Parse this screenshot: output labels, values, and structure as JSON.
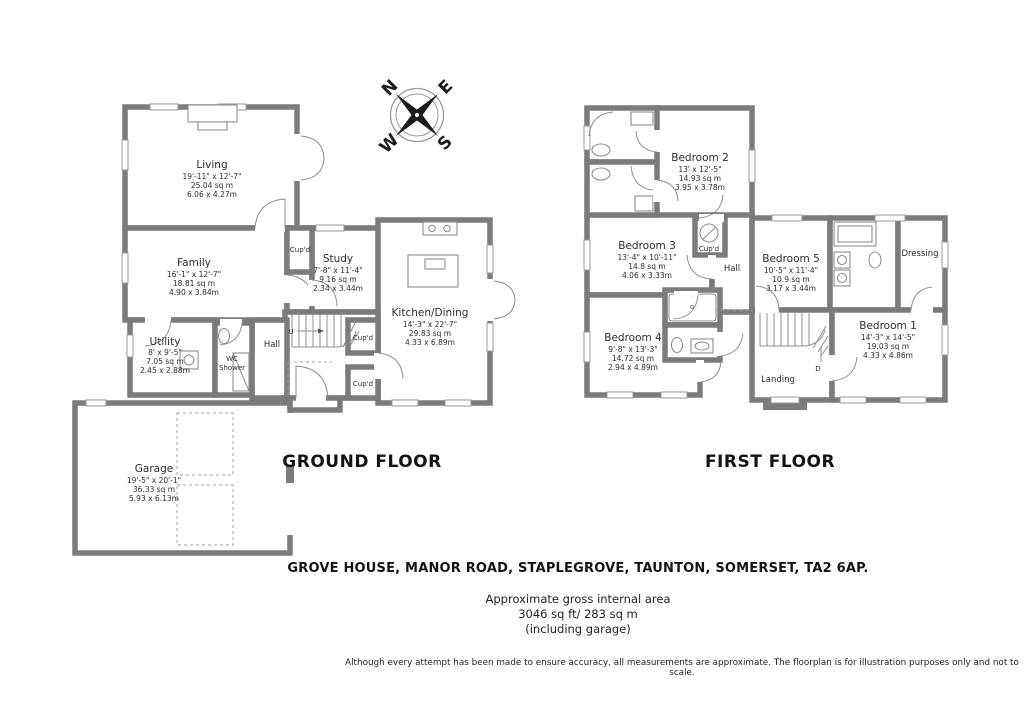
{
  "page": {
    "background": "#ffffff",
    "wall_color": "#7b7b7b"
  },
  "floors": {
    "ground": {
      "title": "GROUND FLOOR",
      "rooms": {
        "living": {
          "name": "Living",
          "dims_ft": "19'-11\" x 12'-7\"",
          "area": "25.04 sq m",
          "dims_m": "6.06 x 4.27m"
        },
        "family": {
          "name": "Family",
          "dims_ft": "16'-1\" x 12'-7\"",
          "area": "18.81 sq m",
          "dims_m": "4.90 x 3.84m"
        },
        "study": {
          "name": "Study",
          "dims_ft": "7'-8\" x 11'-4\"",
          "area": "9.16 sq m",
          "dims_m": "2.34 x 3.44m"
        },
        "kitchen": {
          "name": "Kitchen/Dining",
          "dims_ft": "14'-3\" x 22'-7\"",
          "area": "29.83 sq m",
          "dims_m": "4.33 x 6.89m"
        },
        "utility": {
          "name": "Utility",
          "dims_ft": "8' x 9'-5\"",
          "area": "7.05 sq m",
          "dims_m": "2.45 x 2.88m"
        },
        "garage": {
          "name": "Garage",
          "dims_ft": "19'-5\" x 20'-1\"",
          "area": "36.33 sq m",
          "dims_m": "5.93 x 6.13m"
        }
      }
    },
    "first": {
      "title": "FIRST FLOOR",
      "rooms": {
        "bed1": {
          "name": "Bedroom 1",
          "dims_ft": "14'-3\" x 14'-5\"",
          "area": "19.03 sq m",
          "dims_m": "4.33 x 4.86m"
        },
        "bed2": {
          "name": "Bedroom 2",
          "dims_ft": "13' x 12'-5\"",
          "area": "14.93 sq m",
          "dims_m": "3.95 x 3.78m"
        },
        "bed3": {
          "name": "Bedroom 3",
          "dims_ft": "13'-4\" x 10'-11\"",
          "area": "14.8 sq m",
          "dims_m": "4.06 x 3.33m"
        },
        "bed4": {
          "name": "Bedroom 4",
          "dims_ft": "9'-8\" x 13'-3\"",
          "area": "14.72 sq m",
          "dims_m": "2.94 x 4.89m"
        },
        "bed5": {
          "name": "Bedroom 5",
          "dims_ft": "10'-5\" x 11'-4\"",
          "area": "10.9 sq m",
          "dims_m": "3.17 x 3.44m"
        }
      }
    }
  },
  "labels": {
    "hall": "Hall",
    "landing": "Landing",
    "dressing": "Dressing",
    "cupd": "Cup'd",
    "wc": "WC",
    "shower": "Shower",
    "up": "U",
    "down": "D"
  },
  "compass": {
    "n": "N",
    "e": "E",
    "s": "S",
    "w": "W"
  },
  "footer": {
    "address": "GROVE HOUSE, MANOR ROAD, STAPLEGROVE, TAUNTON, SOMERSET, TA2 6AP.",
    "area_title": "Approximate gross internal area",
    "area_value": "3046 sq ft/ 283 sq m",
    "area_note": "(including garage)",
    "disclaimer": "Although every attempt has been made to ensure accuracy, all measurements are approximate. The floorplan is for illustration purposes only and not to scale."
  }
}
